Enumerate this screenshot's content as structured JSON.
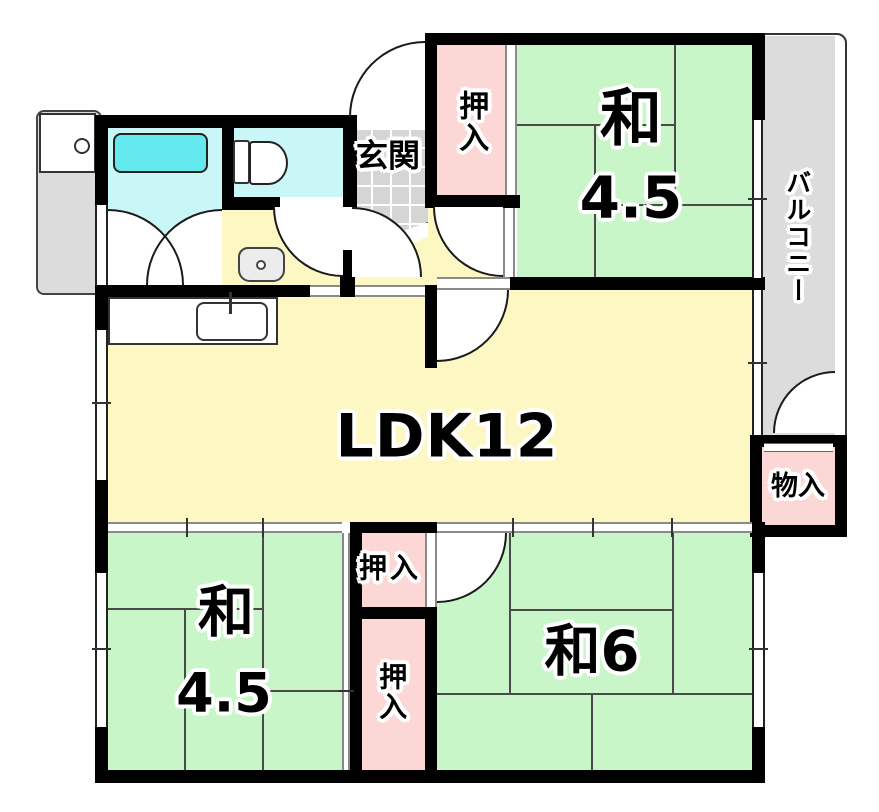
{
  "rooms": {
    "entrance": {
      "label": "玄関"
    },
    "closet_top": {
      "label": "押入"
    },
    "japanese_room_top": {
      "name": "和",
      "size": "4.5"
    },
    "balcony": {
      "label": "バルコニー"
    },
    "ldk": {
      "label": "LDK12"
    },
    "storage": {
      "label": "物入"
    },
    "closet_middle_upper": {
      "label": "押入"
    },
    "closet_middle_lower": {
      "label": "押入"
    },
    "japanese_room_bottom_left": {
      "name": "和",
      "size": "4.5"
    },
    "japanese_room_bottom_right": {
      "label": "和6"
    }
  },
  "colors": {
    "tatami_green": "#c9f6c9",
    "ldk_yellow": "#fdf8c3",
    "closet_pink": "#fbd8d6",
    "bath_cyan": "#c9f6f6",
    "tub_cyan": "#63e9ee",
    "floor_gray": "#dcdcdc",
    "wall_black": "#000000"
  }
}
